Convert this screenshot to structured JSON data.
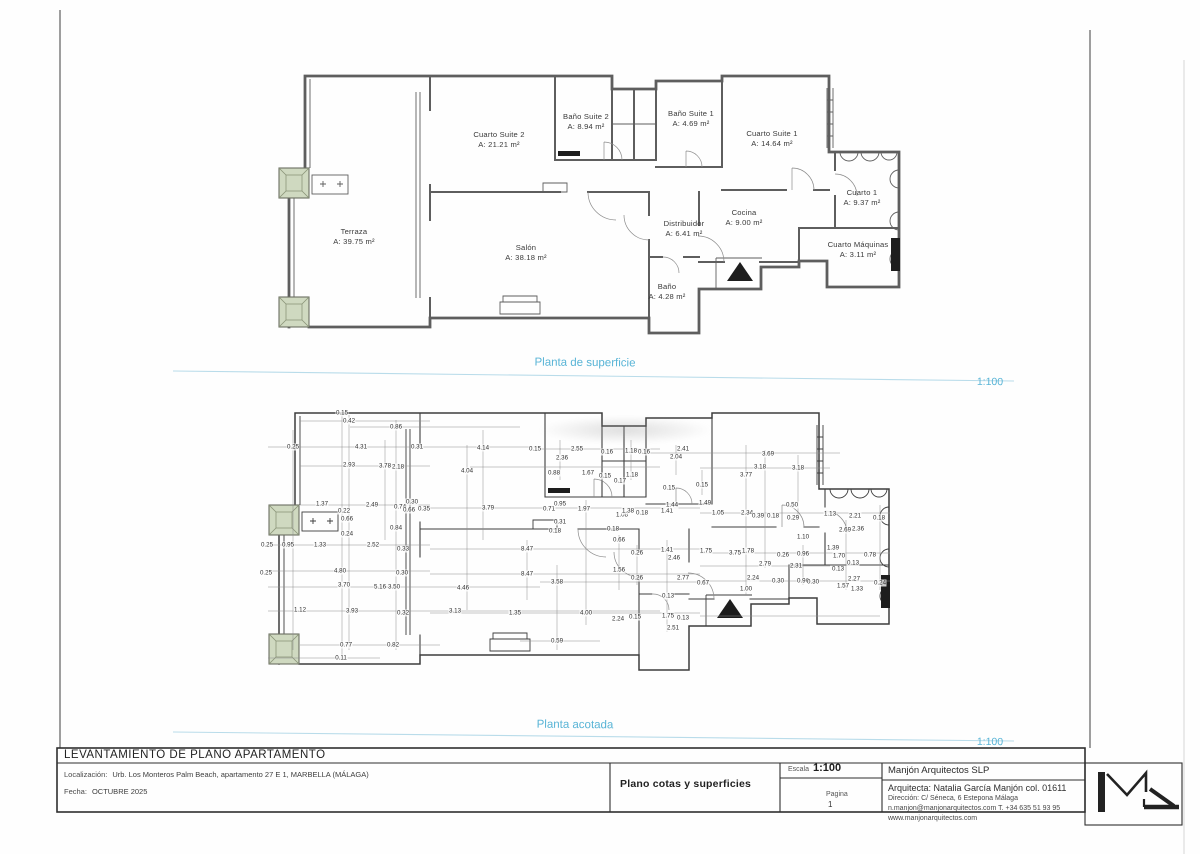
{
  "accent_color": "#58b4d6",
  "plans": {
    "superficie": {
      "title": "Planta de superficie",
      "scale": "1:100",
      "rooms": [
        {
          "name": "Cuarto Suite 2",
          "area": "A: 21.21 m²",
          "x": 499,
          "y": 130
        },
        {
          "name": "Baño Suite 2",
          "area": "A: 8.94 m²",
          "x": 586,
          "y": 112
        },
        {
          "name": "Baño Suite 1",
          "area": "A: 4.69 m²",
          "x": 691,
          "y": 109
        },
        {
          "name": "Cuarto Suite 1",
          "area": "A: 14.64 m²",
          "x": 772,
          "y": 129
        },
        {
          "name": "Cuarto 1",
          "area": "A: 9.37 m²",
          "x": 862,
          "y": 188
        },
        {
          "name": "Terraza",
          "area": "A: 39.75 m²",
          "x": 354,
          "y": 227
        },
        {
          "name": "Salón",
          "area": "A: 38.18 m²",
          "x": 526,
          "y": 243
        },
        {
          "name": "Distribuidor",
          "area": "A: 6.41 m²",
          "x": 684,
          "y": 219
        },
        {
          "name": "Cocina",
          "area": "A: 9.00 m²",
          "x": 744,
          "y": 208
        },
        {
          "name": "Cuarto Máquinas",
          "area": "A: 3.11 m²",
          "x": 858,
          "y": 240
        },
        {
          "name": "Baño",
          "area": "A: 4.28 m²",
          "x": 667,
          "y": 282
        }
      ]
    },
    "acotada": {
      "title": "Planta acotada",
      "scale": "1:100",
      "dimensions": [
        {
          "t": "0.15",
          "x": 342,
          "y": 413
        },
        {
          "t": "0.42",
          "x": 349,
          "y": 421
        },
        {
          "t": "0.86",
          "x": 396,
          "y": 427
        },
        {
          "t": "0.25",
          "x": 293,
          "y": 447
        },
        {
          "t": "4.31",
          "x": 361,
          "y": 447
        },
        {
          "t": "0.31",
          "x": 417,
          "y": 447
        },
        {
          "t": "4.14",
          "x": 483,
          "y": 448
        },
        {
          "t": "0.15",
          "x": 535,
          "y": 449
        },
        {
          "t": "2.55",
          "x": 577,
          "y": 449
        },
        {
          "t": "0.16",
          "x": 607,
          "y": 452
        },
        {
          "t": "1.18",
          "x": 631,
          "y": 451
        },
        {
          "t": "0.16",
          "x": 644,
          "y": 452
        },
        {
          "t": "2.41",
          "x": 683,
          "y": 449
        },
        {
          "t": "2.04",
          "x": 676,
          "y": 457
        },
        {
          "t": "3.69",
          "x": 768,
          "y": 454
        },
        {
          "t": "2.93",
          "x": 349,
          "y": 465
        },
        {
          "t": "3.78",
          "x": 385,
          "y": 466
        },
        {
          "t": "2.18",
          "x": 398,
          "y": 467
        },
        {
          "t": "2.36",
          "x": 562,
          "y": 458
        },
        {
          "t": "3.18",
          "x": 760,
          "y": 467
        },
        {
          "t": "3.18",
          "x": 798,
          "y": 468
        },
        {
          "t": "4.04",
          "x": 467,
          "y": 471
        },
        {
          "t": "0.88",
          "x": 554,
          "y": 473
        },
        {
          "t": "1.67",
          "x": 588,
          "y": 473
        },
        {
          "t": "0.15",
          "x": 605,
          "y": 476
        },
        {
          "t": "1.18",
          "x": 632,
          "y": 475
        },
        {
          "t": "0.17",
          "x": 620,
          "y": 481
        },
        {
          "t": "3.77",
          "x": 746,
          "y": 475
        },
        {
          "t": "0.15",
          "x": 702,
          "y": 485
        },
        {
          "t": "0.15",
          "x": 669,
          "y": 488
        },
        {
          "t": "1.37",
          "x": 322,
          "y": 504
        },
        {
          "t": "2.49",
          "x": 372,
          "y": 505
        },
        {
          "t": "0.30",
          "x": 412,
          "y": 502
        },
        {
          "t": "0.74",
          "x": 400,
          "y": 507
        },
        {
          "t": "0.66",
          "x": 409,
          "y": 510
        },
        {
          "t": "0.35",
          "x": 424,
          "y": 509
        },
        {
          "t": "0.22",
          "x": 344,
          "y": 511
        },
        {
          "t": "0.66",
          "x": 347,
          "y": 519
        },
        {
          "t": "0.24",
          "x": 347,
          "y": 534
        },
        {
          "t": "0.84",
          "x": 396,
          "y": 528
        },
        {
          "t": "3.79",
          "x": 488,
          "y": 508
        },
        {
          "t": "0.71",
          "x": 549,
          "y": 509
        },
        {
          "t": "0.95",
          "x": 560,
          "y": 504
        },
        {
          "t": "1.97",
          "x": 584,
          "y": 509
        },
        {
          "t": "1.08",
          "x": 622,
          "y": 515
        },
        {
          "t": "1.38",
          "x": 628,
          "y": 511
        },
        {
          "t": "0.18",
          "x": 642,
          "y": 513
        },
        {
          "t": "1.41",
          "x": 667,
          "y": 511
        },
        {
          "t": "1.44",
          "x": 672,
          "y": 505
        },
        {
          "t": "1.49",
          "x": 705,
          "y": 503
        },
        {
          "t": "1.05",
          "x": 718,
          "y": 513
        },
        {
          "t": "2.34",
          "x": 747,
          "y": 513
        },
        {
          "t": "0.39",
          "x": 758,
          "y": 516
        },
        {
          "t": "0.18",
          "x": 773,
          "y": 516
        },
        {
          "t": "0.50",
          "x": 792,
          "y": 505
        },
        {
          "t": "0.29",
          "x": 793,
          "y": 518
        },
        {
          "t": "1.13",
          "x": 830,
          "y": 514
        },
        {
          "t": "2.21",
          "x": 855,
          "y": 516
        },
        {
          "t": "0.18",
          "x": 879,
          "y": 518
        },
        {
          "t": "0.31",
          "x": 560,
          "y": 522
        },
        {
          "t": "0.18",
          "x": 555,
          "y": 531
        },
        {
          "t": "0.18",
          "x": 613,
          "y": 529
        },
        {
          "t": "2.69",
          "x": 845,
          "y": 530
        },
        {
          "t": "2.36",
          "x": 858,
          "y": 529
        },
        {
          "t": "1.10",
          "x": 803,
          "y": 537
        },
        {
          "t": "0.25",
          "x": 267,
          "y": 545
        },
        {
          "t": "0.95",
          "x": 288,
          "y": 545
        },
        {
          "t": "1.33",
          "x": 320,
          "y": 545
        },
        {
          "t": "2.52",
          "x": 373,
          "y": 545
        },
        {
          "t": "0.33",
          "x": 403,
          "y": 549
        },
        {
          "t": "8.47",
          "x": 527,
          "y": 549
        },
        {
          "t": "0.66",
          "x": 619,
          "y": 540
        },
        {
          "t": "0.26",
          "x": 637,
          "y": 553
        },
        {
          "t": "1.41",
          "x": 667,
          "y": 550
        },
        {
          "t": "2.46",
          "x": 674,
          "y": 558
        },
        {
          "t": "1.75",
          "x": 706,
          "y": 551
        },
        {
          "t": "3.75",
          "x": 735,
          "y": 553
        },
        {
          "t": "1.78",
          "x": 748,
          "y": 551
        },
        {
          "t": "0.26",
          "x": 783,
          "y": 555
        },
        {
          "t": "0.96",
          "x": 803,
          "y": 554
        },
        {
          "t": "1.39",
          "x": 833,
          "y": 548
        },
        {
          "t": "1.70",
          "x": 839,
          "y": 556
        },
        {
          "t": "0.78",
          "x": 870,
          "y": 555
        },
        {
          "t": "0.13",
          "x": 853,
          "y": 563
        },
        {
          "t": "0.13",
          "x": 838,
          "y": 569
        },
        {
          "t": "2.79",
          "x": 765,
          "y": 564
        },
        {
          "t": "2.31",
          "x": 796,
          "y": 566
        },
        {
          "t": "0.25",
          "x": 266,
          "y": 573
        },
        {
          "t": "4.80",
          "x": 340,
          "y": 571
        },
        {
          "t": "0.30",
          "x": 402,
          "y": 573
        },
        {
          "t": "8.47",
          "x": 527,
          "y": 574
        },
        {
          "t": "1.56",
          "x": 619,
          "y": 570
        },
        {
          "t": "0.26",
          "x": 637,
          "y": 578
        },
        {
          "t": "3.70",
          "x": 344,
          "y": 585
        },
        {
          "t": "5.16",
          "x": 380,
          "y": 587
        },
        {
          "t": "3.50",
          "x": 394,
          "y": 587
        },
        {
          "t": "3.58",
          "x": 557,
          "y": 582
        },
        {
          "t": "4.46",
          "x": 463,
          "y": 588
        },
        {
          "t": "2.77",
          "x": 683,
          "y": 578
        },
        {
          "t": "0.67",
          "x": 703,
          "y": 583
        },
        {
          "t": "2.24",
          "x": 753,
          "y": 578
        },
        {
          "t": "0.30",
          "x": 778,
          "y": 581
        },
        {
          "t": "0.96",
          "x": 803,
          "y": 581
        },
        {
          "t": "0.30",
          "x": 813,
          "y": 582
        },
        {
          "t": "1.57",
          "x": 843,
          "y": 586
        },
        {
          "t": "2.27",
          "x": 854,
          "y": 579
        },
        {
          "t": "1.33",
          "x": 857,
          "y": 589
        },
        {
          "t": "0.24",
          "x": 880,
          "y": 583
        },
        {
          "t": "1.00",
          "x": 746,
          "y": 589
        },
        {
          "t": "0.13",
          "x": 668,
          "y": 596
        },
        {
          "t": "1.12",
          "x": 300,
          "y": 610
        },
        {
          "t": "3.93",
          "x": 352,
          "y": 611
        },
        {
          "t": "0.32",
          "x": 403,
          "y": 613
        },
        {
          "t": "3.13",
          "x": 455,
          "y": 611
        },
        {
          "t": "1.35",
          "x": 515,
          "y": 613
        },
        {
          "t": "4.00",
          "x": 586,
          "y": 613
        },
        {
          "t": "2.24",
          "x": 618,
          "y": 619
        },
        {
          "t": "0.15",
          "x": 635,
          "y": 617
        },
        {
          "t": "1.75",
          "x": 668,
          "y": 616
        },
        {
          "t": "2.51",
          "x": 673,
          "y": 628
        },
        {
          "t": "0.13",
          "x": 683,
          "y": 618
        },
        {
          "t": "0.77",
          "x": 346,
          "y": 645
        },
        {
          "t": "0.82",
          "x": 393,
          "y": 645
        },
        {
          "t": "0.59",
          "x": 557,
          "y": 641
        },
        {
          "t": "0.11",
          "x": 341,
          "y": 658
        }
      ]
    }
  },
  "title_block": {
    "project_title": "LEVANTAMIENTO DE PLANO APARTAMENTO",
    "location_label": "Localización:",
    "location_value": "Urb. Los Monteros Palm Beach, apartamento 27 E 1, MARBELLA (MÁLAGA)",
    "date_label": "Fecha:",
    "date_value": "OCTUBRE 2025",
    "sheet_title": "Plano cotas y superficies",
    "scale_label": "Escala",
    "scale_value": "1:100",
    "page_label": "Pagina",
    "page_number": "1",
    "firm_name": "Manjón Arquitectos SLP",
    "architect_line": "Arquitecta: Natalia García Manjón col. 01611",
    "address_line": "Dirección: C/ Séneca, 6 Estepona Málaga",
    "contact_line": "n.manjon@manjonarquitectos.com T. +34 635 51 93 95",
    "website_line": "www.manjonarquitectos.com"
  }
}
